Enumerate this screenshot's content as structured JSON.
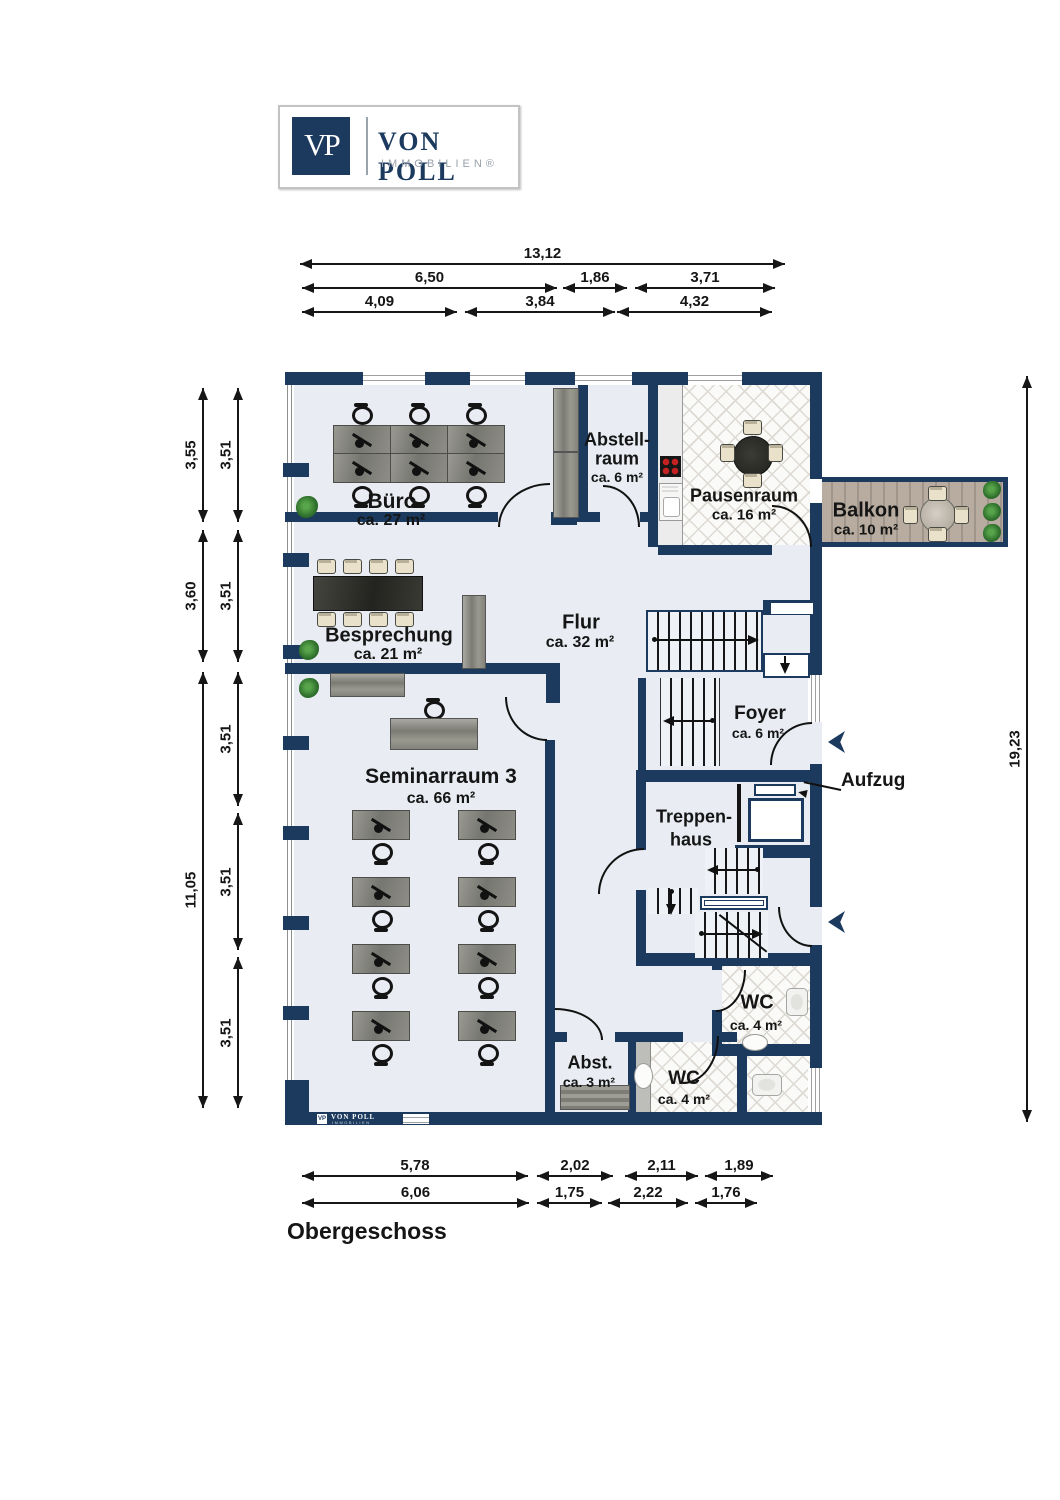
{
  "brand": {
    "initials": "VP",
    "name": "VON POLL",
    "subtitle": "IMMOBILIEN®"
  },
  "watermark": {
    "initials": "VP",
    "name": "VON POLL",
    "subtitle": "IMMOBILIEN"
  },
  "floor_title": "Obergeschoss",
  "colors": {
    "wall": "#1b3a5e",
    "floor": "#e9edf3",
    "stove_burner": "#c42222",
    "wood": "#b3a89e"
  },
  "rooms": {
    "buero": {
      "name": "Büro",
      "area": "ca. 27 m²"
    },
    "abstellraum": {
      "name1": "Abstell-",
      "name2": "raum",
      "area": "ca. 6 m²"
    },
    "pausenraum": {
      "name": "Pausenraum",
      "area": "ca. 16 m²"
    },
    "balkon": {
      "name": "Balkon",
      "area": "ca. 10 m²"
    },
    "besprechung": {
      "name": "Besprechung",
      "area": "ca. 21 m²"
    },
    "flur": {
      "name": "Flur",
      "area": "ca. 32 m²"
    },
    "foyer": {
      "name": "Foyer",
      "area": "ca. 6 m²"
    },
    "treppenhaus": {
      "name1": "Treppen-",
      "name2": "haus"
    },
    "aufzug": {
      "name": "Aufzug"
    },
    "seminarraum": {
      "name": "Seminarraum 3",
      "area": "ca. 66 m²"
    },
    "wc_og": {
      "name": "WC",
      "area": "ca. 4 m²"
    },
    "wc_unten": {
      "name": "WC",
      "area": "ca. 4 m²"
    },
    "abstellkammer": {
      "name": "Abst.",
      "area": "ca. 3 m²"
    }
  },
  "dimensions": {
    "top_row1": [
      "13,12"
    ],
    "top_row2": [
      "6,50",
      "1,86",
      "3,71"
    ],
    "top_row3": [
      "4,09",
      "3,84",
      "4,32"
    ],
    "bottom_row1": [
      "5,78",
      "2,02",
      "2,11",
      "1,89"
    ],
    "bottom_row2": [
      "6,06",
      "1,75",
      "2,22",
      "1,76"
    ],
    "left_outer": [
      "3,55",
      "3,60",
      "11,05"
    ],
    "left_inner": [
      "3,51",
      "3,51",
      "3,51",
      "3,51",
      "3,51"
    ],
    "right": [
      "19,23"
    ]
  }
}
